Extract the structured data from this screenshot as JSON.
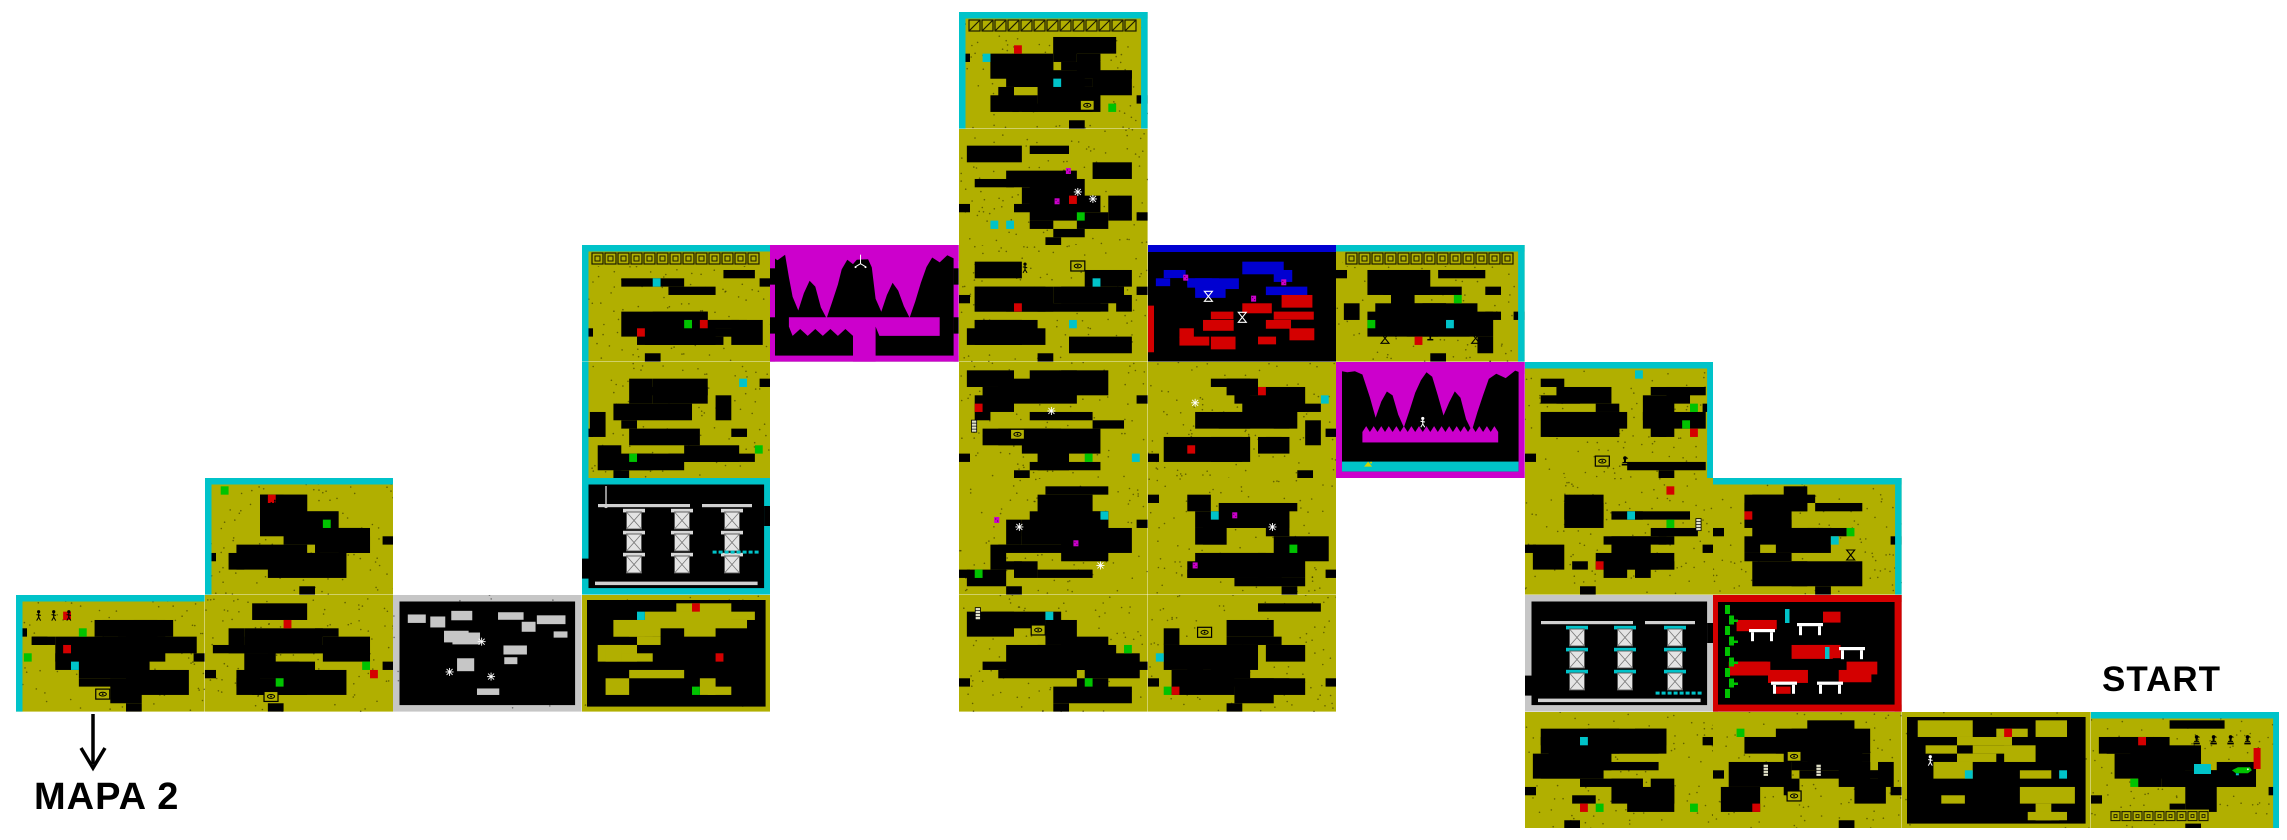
{
  "canvas": {
    "width": 2287,
    "height": 840,
    "background": "#ffffff"
  },
  "grid": {
    "x0": 16,
    "y0": 12,
    "cell_w": 188.6,
    "cell_h": 116.6
  },
  "palette": {
    "yellow": "#b1af00",
    "black": "#000000",
    "cyan": "#00c3c9",
    "magenta": "#cc00cc",
    "red": "#d40000",
    "green": "#00c300",
    "blue": "#0000d1",
    "grey": "#c6c6c6",
    "white": "#ffffff",
    "column_light": "#e4e4e4",
    "shelf_grey": "#d0d0d0"
  },
  "labels": {
    "mapa2": {
      "text": "MAPA 2",
      "x": 34,
      "y": 776,
      "size": 38
    },
    "start": {
      "text": "START",
      "x": 2102,
      "y": 660,
      "size": 35
    }
  },
  "arrow": {
    "x": 70,
    "y": 712,
    "w": 46,
    "h": 62
  },
  "rooms": [
    {
      "name": "room-c0-r5",
      "col": 0,
      "row": 5,
      "type": "yellow",
      "seed": 1,
      "borders": {
        "top": "cyan",
        "left": "cyan"
      },
      "accents": [
        "green",
        "red",
        "cyan",
        "red",
        "green"
      ],
      "icons": [
        {
          "type": "figure",
          "x": 12,
          "y": 18
        },
        {
          "type": "figure",
          "x": 20,
          "y": 18
        },
        {
          "type": "figure",
          "x": 28,
          "y": 18
        },
        {
          "type": "eye-plaque",
          "x": 46,
          "y": 85
        }
      ]
    },
    {
      "name": "room-c1-r4",
      "col": 1,
      "row": 4,
      "type": "yellow",
      "seed": 2,
      "borders": {
        "top": "cyan",
        "left": "cyan"
      },
      "accents": [
        "green",
        "green",
        "red"
      ],
      "icons": [
        {
          "type": "candelabra",
          "x": 37,
          "y": 24
        },
        {
          "type": "candelabra",
          "x": 45,
          "y": 24
        },
        {
          "type": "figure",
          "x": 60,
          "y": 42
        },
        {
          "type": "figure",
          "x": 60,
          "y": 68
        }
      ]
    },
    {
      "name": "room-c1-r5",
      "col": 1,
      "row": 5,
      "type": "yellow",
      "seed": 3,
      "borders": {},
      "accents": [
        "green",
        "red",
        "red",
        "green"
      ],
      "icons": [
        {
          "type": "eye-plaque",
          "x": 35,
          "y": 87
        }
      ]
    },
    {
      "name": "room-c2-r5",
      "col": 2,
      "row": 5,
      "type": "white",
      "seed": 4,
      "borders": {},
      "accents": [],
      "icons": [
        {
          "type": "sparkle",
          "x": 30,
          "y": 66
        },
        {
          "type": "sparkle",
          "x": 52,
          "y": 70
        },
        {
          "type": "sparkle",
          "x": 47,
          "y": 40
        }
      ]
    },
    {
      "name": "room-c3-r5",
      "col": 3,
      "row": 5,
      "type": "dark",
      "seed": 5,
      "borders": {},
      "accents": [
        "red",
        "red",
        "cyan",
        "green"
      ],
      "icons": []
    },
    {
      "name": "room-c3-r4",
      "col": 3,
      "row": 4,
      "type": "columns-cyan",
      "seed": 6,
      "borders": {},
      "accents": [],
      "icons": []
    },
    {
      "name": "room-c3-r3",
      "col": 3,
      "row": 3,
      "type": "yellow",
      "seed": 7,
      "borders": {
        "left": "cyan"
      },
      "accents": [
        "green",
        "green",
        "cyan"
      ],
      "icons": []
    },
    {
      "name": "room-c3-r2",
      "col": 3,
      "row": 2,
      "type": "greek",
      "seed": 8,
      "borders": {
        "top": "cyan",
        "left": "cyan"
      },
      "accents": [
        "red",
        "cyan",
        "red",
        "green"
      ],
      "icons": [
        {
          "type": "bird-statue",
          "x": 37,
          "y": 80
        },
        {
          "type": "bird-statue",
          "x": 44,
          "y": 80
        },
        {
          "type": "bird-statue",
          "x": 51,
          "y": 80
        }
      ]
    },
    {
      "name": "room-c4-r2",
      "col": 4,
      "row": 2,
      "type": "cave1",
      "seed": 9,
      "borders": {},
      "accents": [],
      "icons": [
        {
          "type": "chandelier",
          "x": 48,
          "y": 16
        }
      ]
    },
    {
      "name": "room-c5-r0",
      "col": 5,
      "row": 0,
      "type": "tower",
      "seed": 10,
      "borders": {
        "top": "cyan",
        "left": "cyan",
        "right": "cyan"
      },
      "accents": [
        "green",
        "red",
        "cyan",
        "cyan"
      ],
      "icons": [
        {
          "type": "bird-statue",
          "x": 30,
          "y": 82
        },
        {
          "type": "bird-statue",
          "x": 40,
          "y": 82
        },
        {
          "type": "eye-plaque",
          "x": 68,
          "y": 80
        }
      ]
    },
    {
      "name": "room-c5-r1",
      "col": 5,
      "row": 1,
      "type": "yellow",
      "seed": 11,
      "borders": {},
      "accents": [
        "cyan",
        "red",
        "green",
        "cyan"
      ],
      "icons": [
        {
          "type": "enemy",
          "x": 58,
          "y": 36
        },
        {
          "type": "enemy",
          "x": 52,
          "y": 62
        },
        {
          "type": "sparkle",
          "x": 63,
          "y": 54
        },
        {
          "type": "sparkle",
          "x": 71,
          "y": 60
        }
      ]
    },
    {
      "name": "room-c5-r2",
      "col": 5,
      "row": 2,
      "type": "yellow",
      "seed": 12,
      "borders": {},
      "accents": [
        "red",
        "cyan",
        "cyan"
      ],
      "icons": [
        {
          "type": "figure",
          "x": 27,
          "y": 20
        },
        {
          "type": "figure",
          "x": 35,
          "y": 20
        },
        {
          "type": "eye-plaque",
          "x": 63,
          "y": 18
        }
      ]
    },
    {
      "name": "room-c5-r3",
      "col": 5,
      "row": 3,
      "type": "yellow",
      "seed": 13,
      "borders": {},
      "accents": [
        "green",
        "red",
        "cyan"
      ],
      "icons": [
        {
          "type": "mummy",
          "x": 8,
          "y": 55
        },
        {
          "type": "eye-plaque",
          "x": 31,
          "y": 62
        },
        {
          "type": "sparkle",
          "x": 49,
          "y": 42
        }
      ]
    },
    {
      "name": "room-c6-r3",
      "col": 6,
      "row": 3,
      "type": "yellow",
      "seed": 14,
      "borders": {},
      "accents": [
        "red",
        "cyan",
        "red"
      ],
      "icons": [
        {
          "type": "sparkle",
          "x": 25,
          "y": 35
        }
      ]
    },
    {
      "name": "room-c5-r4",
      "col": 5,
      "row": 4,
      "type": "yellow",
      "seed": 15,
      "borders": {},
      "accents": [
        "cyan",
        "green"
      ],
      "icons": [
        {
          "type": "enemy",
          "x": 20,
          "y": 36
        },
        {
          "type": "enemy",
          "x": 62,
          "y": 56
        },
        {
          "type": "sparkle",
          "x": 32,
          "y": 42
        },
        {
          "type": "sparkle",
          "x": 75,
          "y": 75
        }
      ]
    },
    {
      "name": "room-c6-r4",
      "col": 6,
      "row": 4,
      "type": "yellow",
      "seed": 16,
      "borders": {},
      "accents": [
        "green",
        "cyan"
      ],
      "icons": [
        {
          "type": "enemy",
          "x": 46,
          "y": 32
        },
        {
          "type": "sparkle",
          "x": 66,
          "y": 42
        },
        {
          "type": "enemy",
          "x": 25,
          "y": 75
        }
      ]
    },
    {
      "name": "room-c5-r5",
      "col": 5,
      "row": 5,
      "type": "yellow",
      "seed": 17,
      "borders": {},
      "accents": [
        "green",
        "green",
        "cyan"
      ],
      "icons": [
        {
          "type": "mummy",
          "x": 10,
          "y": 16
        },
        {
          "type": "eye-plaque",
          "x": 42,
          "y": 30
        }
      ]
    },
    {
      "name": "room-c6-r5",
      "col": 6,
      "row": 5,
      "type": "yellow",
      "seed": 18,
      "borders": {},
      "accents": [
        "green",
        "cyan",
        "red"
      ],
      "icons": [
        {
          "type": "eye-plaque",
          "x": 30,
          "y": 32
        }
      ]
    },
    {
      "name": "room-c6-r2",
      "col": 6,
      "row": 2,
      "type": "bluered",
      "seed": 19,
      "borders": {},
      "accents": [],
      "icons": [
        {
          "type": "hourglass-white",
          "x": 32,
          "y": 44
        },
        {
          "type": "hourglass-white",
          "x": 50,
          "y": 62
        },
        {
          "type": "enemy",
          "x": 20,
          "y": 28
        },
        {
          "type": "enemy",
          "x": 56,
          "y": 46
        },
        {
          "type": "enemy",
          "x": 72,
          "y": 32
        }
      ]
    },
    {
      "name": "room-c7-r2",
      "col": 7,
      "row": 2,
      "type": "greek",
      "seed": 20,
      "borders": {
        "top": "cyan",
        "right": "cyan"
      },
      "accents": [
        "green",
        "cyan",
        "red",
        "green"
      ],
      "icons": [
        {
          "type": "hourglass",
          "x": 26,
          "y": 80
        },
        {
          "type": "trophy",
          "x": 50,
          "y": 78
        },
        {
          "type": "hourglass",
          "x": 74,
          "y": 80
        }
      ]
    },
    {
      "name": "room-c7-r3",
      "col": 7,
      "row": 3,
      "type": "cave2",
      "seed": 21,
      "borders": {},
      "accents": [],
      "icons": [
        {
          "type": "figure-white",
          "x": 46,
          "y": 52
        },
        {
          "type": "water-bird",
          "x": 17,
          "y": 88
        }
      ]
    },
    {
      "name": "room-c8-r3",
      "col": 8,
      "row": 3,
      "type": "yellow",
      "seed": 22,
      "borders": {
        "top": "cyan",
        "right": "cyan"
      },
      "accents": [
        "green",
        "green",
        "cyan",
        "red"
      ],
      "icons": [
        {
          "type": "eye-plaque",
          "x": 41,
          "y": 85
        },
        {
          "type": "bird-statue",
          "x": 53,
          "y": 85
        }
      ]
    },
    {
      "name": "room-c8-r4",
      "col": 8,
      "row": 4,
      "type": "yellow",
      "seed": 23,
      "borders": {},
      "accents": [
        "red",
        "green",
        "cyan",
        "red"
      ],
      "icons": [
        {
          "type": "mummy",
          "x": 92,
          "y": 40
        }
      ]
    },
    {
      "name": "room-c9-r4",
      "col": 9,
      "row": 4,
      "type": "yellow",
      "seed": 24,
      "borders": {
        "top": "cyan",
        "right": "cyan"
      },
      "accents": [
        "green",
        "cyan",
        "red"
      ],
      "icons": [
        {
          "type": "hourglass",
          "x": 73,
          "y": 66
        },
        {
          "type": "bird-statue",
          "x": 50,
          "y": 87
        },
        {
          "type": "bird-statue",
          "x": 58,
          "y": 87
        }
      ]
    },
    {
      "name": "room-c8-r5",
      "col": 8,
      "row": 5,
      "type": "columns-grey",
      "seed": 25,
      "borders": {},
      "accents": [],
      "icons": []
    },
    {
      "name": "room-c9-r5",
      "col": 9,
      "row": 5,
      "type": "redroom",
      "seed": 26,
      "borders": {},
      "accents": [],
      "icons": []
    },
    {
      "name": "room-c8-r6",
      "col": 8,
      "row": 6,
      "type": "yellow",
      "seed": 27,
      "borders": {},
      "accents": [
        "green",
        "cyan",
        "red",
        "green"
      ],
      "icons": []
    },
    {
      "name": "room-c9-r6",
      "col": 9,
      "row": 6,
      "type": "yellow",
      "seed": 28,
      "borders": {},
      "accents": [
        "green",
        "red"
      ],
      "icons": [
        {
          "type": "mummy",
          "x": 28,
          "y": 50
        },
        {
          "type": "eye-plaque",
          "x": 43,
          "y": 38
        },
        {
          "type": "eye-plaque",
          "x": 43,
          "y": 72
        },
        {
          "type": "mummy",
          "x": 56,
          "y": 50
        }
      ]
    },
    {
      "name": "room-c10-r6",
      "col": 10,
      "row": 6,
      "type": "dark",
      "seed": 29,
      "borders": {},
      "accents": [
        "cyan",
        "red",
        "cyan"
      ],
      "icons": [
        {
          "type": "figure-white",
          "x": 15,
          "y": 42
        }
      ]
    },
    {
      "name": "room-c11-r6",
      "col": 11,
      "row": 6,
      "type": "start",
      "seed": 30,
      "borders": {
        "top": "cyan",
        "right": "cyan"
      },
      "accents": [
        "red",
        "green"
      ],
      "icons": [
        {
          "type": "bird-statue",
          "x": 56,
          "y": 24
        },
        {
          "type": "bird-statue",
          "x": 65,
          "y": 24
        },
        {
          "type": "bird-statue",
          "x": 74,
          "y": 24
        },
        {
          "type": "bird-statue",
          "x": 83,
          "y": 24
        },
        {
          "type": "crocodile",
          "x": 80,
          "y": 50
        },
        {
          "type": "figure",
          "x": 16,
          "y": 44
        }
      ]
    }
  ]
}
